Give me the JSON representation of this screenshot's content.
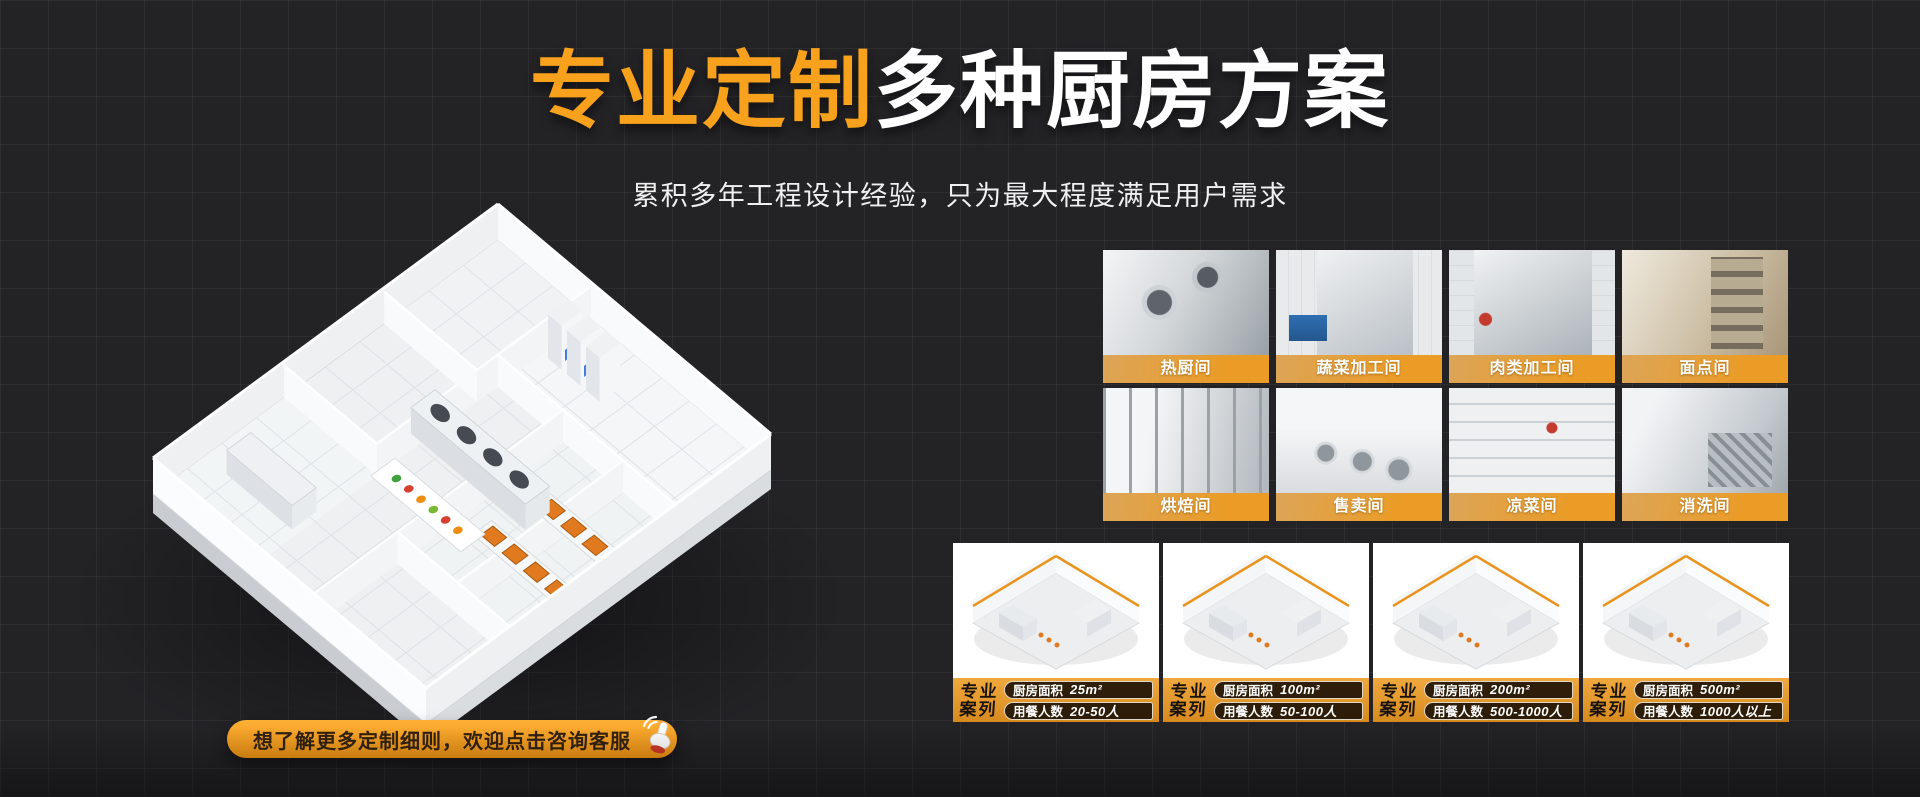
{
  "header": {
    "title_highlight": "专业定制",
    "title_rest": "多种厨房方案",
    "subtitle": "累积多年工程设计经验，只为最大程度满足用户需求"
  },
  "rooms": {
    "items": [
      {
        "label": "热厨间"
      },
      {
        "label": "蔬菜加工间"
      },
      {
        "label": "肉类加工间"
      },
      {
        "label": "面点间"
      },
      {
        "label": "烘焙间"
      },
      {
        "label": "售卖间"
      },
      {
        "label": "凉菜间"
      },
      {
        "label": "消洗间"
      }
    ]
  },
  "cases": {
    "badge_line1": "专业",
    "badge_line2": "案列",
    "items": [
      {
        "area_label": "厨房面积",
        "area_value": "25m²",
        "diners_label": "用餐人数",
        "diners_value": "20-50人"
      },
      {
        "area_label": "厨房面积",
        "area_value": "100m²",
        "diners_label": "用餐人数",
        "diners_value": "50-100人"
      },
      {
        "area_label": "厨房面积",
        "area_value": "200m²",
        "diners_label": "用餐人数",
        "diners_value": "500-1000人"
      },
      {
        "area_label": "厨房面积",
        "area_value": "500m²",
        "diners_label": "用餐人数",
        "diners_value": "1000人以上"
      }
    ]
  },
  "cta": {
    "label": "想了解更多定制细则，欢迎点击咨询客服"
  },
  "colors": {
    "accent_orange": "#F7A11D",
    "label_band_orange": "#EA9C27",
    "case_footer_orange": "#E09A2E",
    "tray_orange": "#E17A1F",
    "background": "#232326"
  }
}
